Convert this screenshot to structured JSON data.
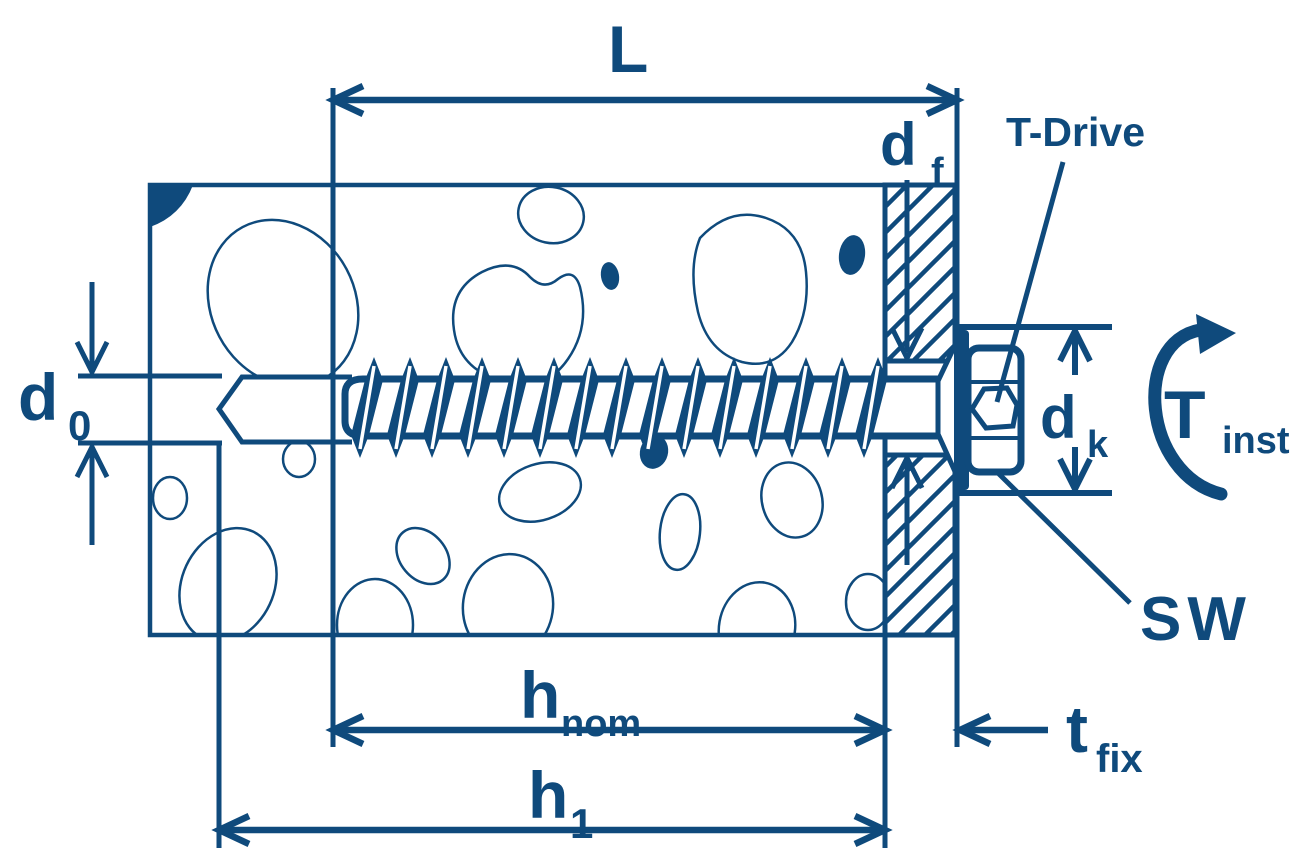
{
  "diagram": {
    "description": "Concrete screw anchor installation cross-section with dimensioning",
    "accent_color": "#0f4a7c",
    "labels": {
      "length": {
        "main": "L"
      },
      "fixture_hole_diameter": {
        "main": "d",
        "sub": "f"
      },
      "drive": {
        "text": "T-Drive"
      },
      "drill_hole_diameter": {
        "main": "d",
        "sub": "0"
      },
      "head_diameter": {
        "main": "d",
        "sub": "k"
      },
      "installation_torque": {
        "main": "T",
        "sub": "inst"
      },
      "wrench_size": {
        "text": "SW"
      },
      "nominal_embedment_depth": {
        "main": "h",
        "sub": "nom"
      },
      "drill_hole_depth": {
        "main": "h",
        "sub": "1"
      },
      "fixture_thickness": {
        "main": "t",
        "sub": "fix"
      }
    }
  }
}
